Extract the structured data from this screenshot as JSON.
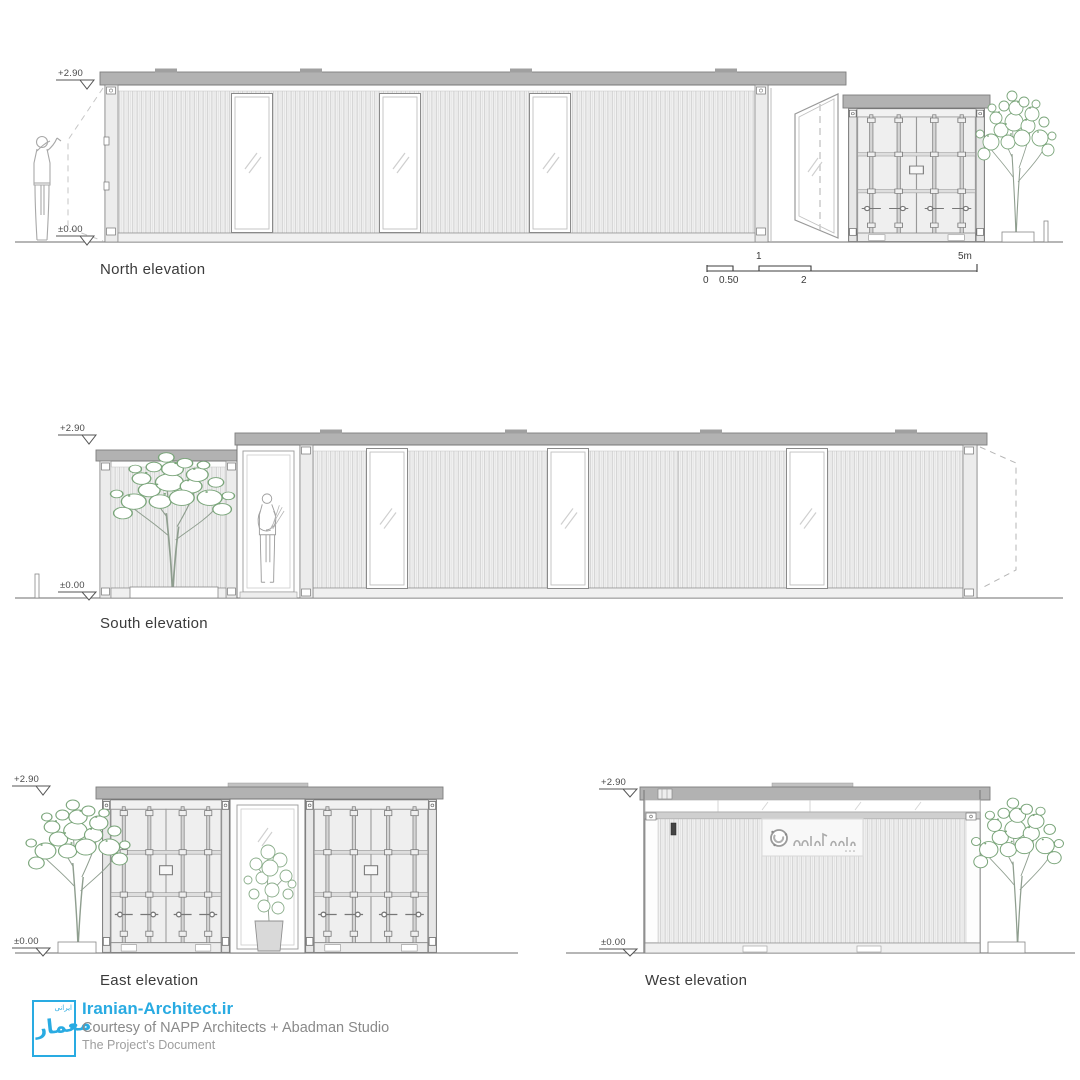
{
  "elevations": {
    "north": {
      "label": "North elevation"
    },
    "south": {
      "label": "South elevation"
    },
    "east": {
      "label": "East elevation"
    },
    "west": {
      "label": "West elevation"
    }
  },
  "levels": {
    "top": "+2.90",
    "ground": "±0.00"
  },
  "scale_bar": {
    "ticks": [
      "0",
      "0.50",
      "1",
      "2",
      "5m"
    ]
  },
  "footer": {
    "site": "Iranian-Architect.ir",
    "courtesy": "Courtesy of NAPP Architects + Abadman Studio",
    "doc": "The Project’s Document",
    "logo_text": "معمار",
    "logo_subtext": "ایرانی"
  },
  "colors": {
    "accent_blue": "#29abe2",
    "roof_gray": "#b2b2b2",
    "siding_light": "#f2f2f2",
    "line_gray": "#8a8a8a",
    "tree_green": "#7aa57a",
    "text_dark": "#3b3b3b",
    "text_gray": "#8a8a8a"
  }
}
